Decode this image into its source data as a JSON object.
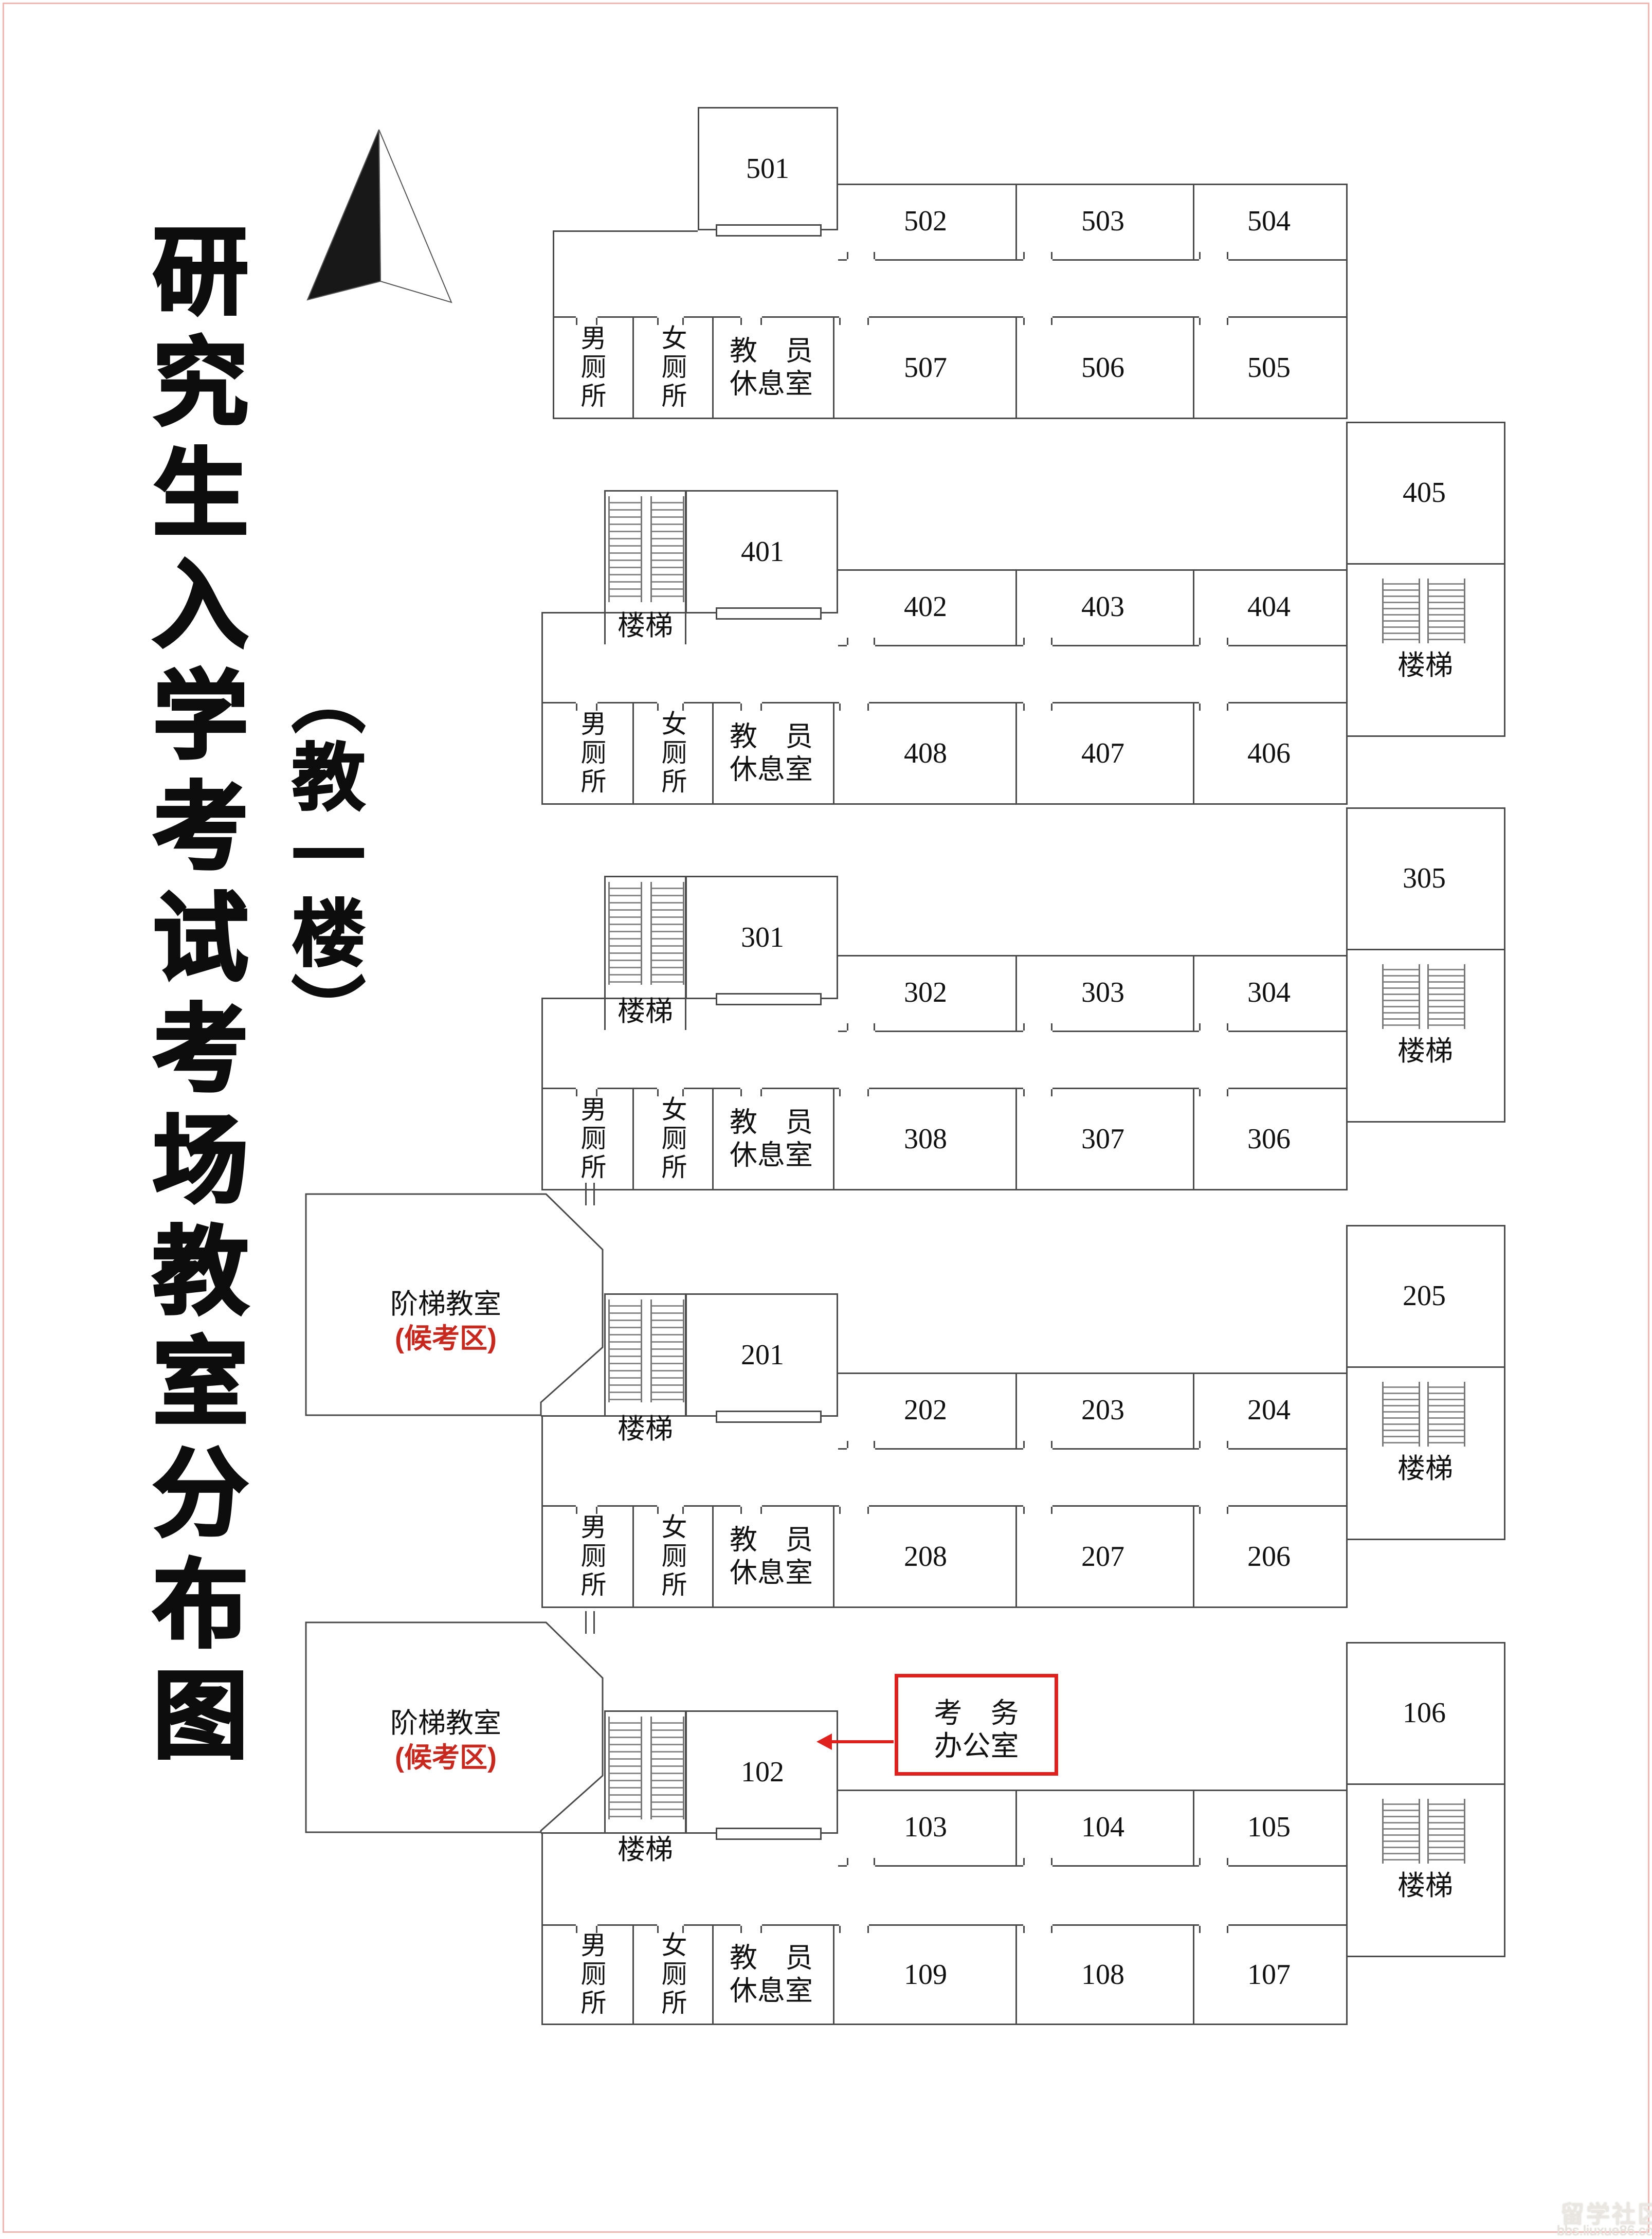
{
  "page": {
    "border_color": "#f3b7b3",
    "background": "#ffffff"
  },
  "title": {
    "text": "研究生入学考试考场教室分布图"
  },
  "subtitle": {
    "text": "（教一楼）"
  },
  "compass": {
    "name": "north-arrow"
  },
  "watermark": {
    "line1": "留学社区",
    "line2": "bbs.liuxue86.com"
  },
  "colors": {
    "wall": "#4a4a4a",
    "red_note": "#c8281e",
    "red_box": "#e0201c"
  },
  "legend": {
    "stairs": "楼梯",
    "men_toilet": "男厕所",
    "women_toilet": "女厕所",
    "lounge": "教员休息室",
    "lecture_hall": "阶梯教室",
    "waiting_area": "(候考区)",
    "exam_office": "考务办公室"
  },
  "floors": [
    {
      "level": 5,
      "hall_room": "501",
      "top_rooms": [
        "502",
        "503",
        "504"
      ],
      "bottom_rooms": [
        "507",
        "506",
        "505"
      ],
      "men_toilet": "男厕所",
      "women_toilet": "女厕所",
      "lounge_line1": "教　员",
      "lounge_line2": "休息室"
    },
    {
      "level": 4,
      "hall_room": "401",
      "top_rooms": [
        "402",
        "403",
        "404"
      ],
      "bottom_rooms": [
        "408",
        "407",
        "406"
      ],
      "men_toilet": "男厕所",
      "women_toilet": "女厕所",
      "lounge_line1": "教　员",
      "lounge_line2": "休息室",
      "stairs_label": "楼梯",
      "side_room": "405"
    },
    {
      "level": 3,
      "hall_room": "301",
      "top_rooms": [
        "302",
        "303",
        "304"
      ],
      "bottom_rooms": [
        "308",
        "307",
        "306"
      ],
      "men_toilet": "男厕所",
      "women_toilet": "女厕所",
      "lounge_line1": "教　员",
      "lounge_line2": "休息室",
      "stairs_label": "楼梯",
      "side_room": "305"
    },
    {
      "level": 2,
      "hall_room": "201",
      "top_rooms": [
        "202",
        "203",
        "204"
      ],
      "bottom_rooms": [
        "208",
        "207",
        "206"
      ],
      "men_toilet": "男厕所",
      "women_toilet": "女厕所",
      "lounge_line1": "教　员",
      "lounge_line2": "休息室",
      "stairs_label": "楼梯",
      "side_room": "205",
      "lecture_hall": "阶梯教室",
      "lecture_hall_note": "(候考区)"
    },
    {
      "level": 1,
      "hall_room": "102",
      "top_rooms": [
        "103",
        "104",
        "105"
      ],
      "bottom_rooms": [
        "109",
        "108",
        "107"
      ],
      "men_toilet": "男厕所",
      "women_toilet": "女厕所",
      "lounge_line1": "教　员",
      "lounge_line2": "休息室",
      "stairs_label": "楼梯",
      "side_room": "106",
      "lecture_hall": "阶梯教室",
      "lecture_hall_note": "(候考区)",
      "office_line1": "考　务",
      "office_line2": "办公室"
    }
  ]
}
